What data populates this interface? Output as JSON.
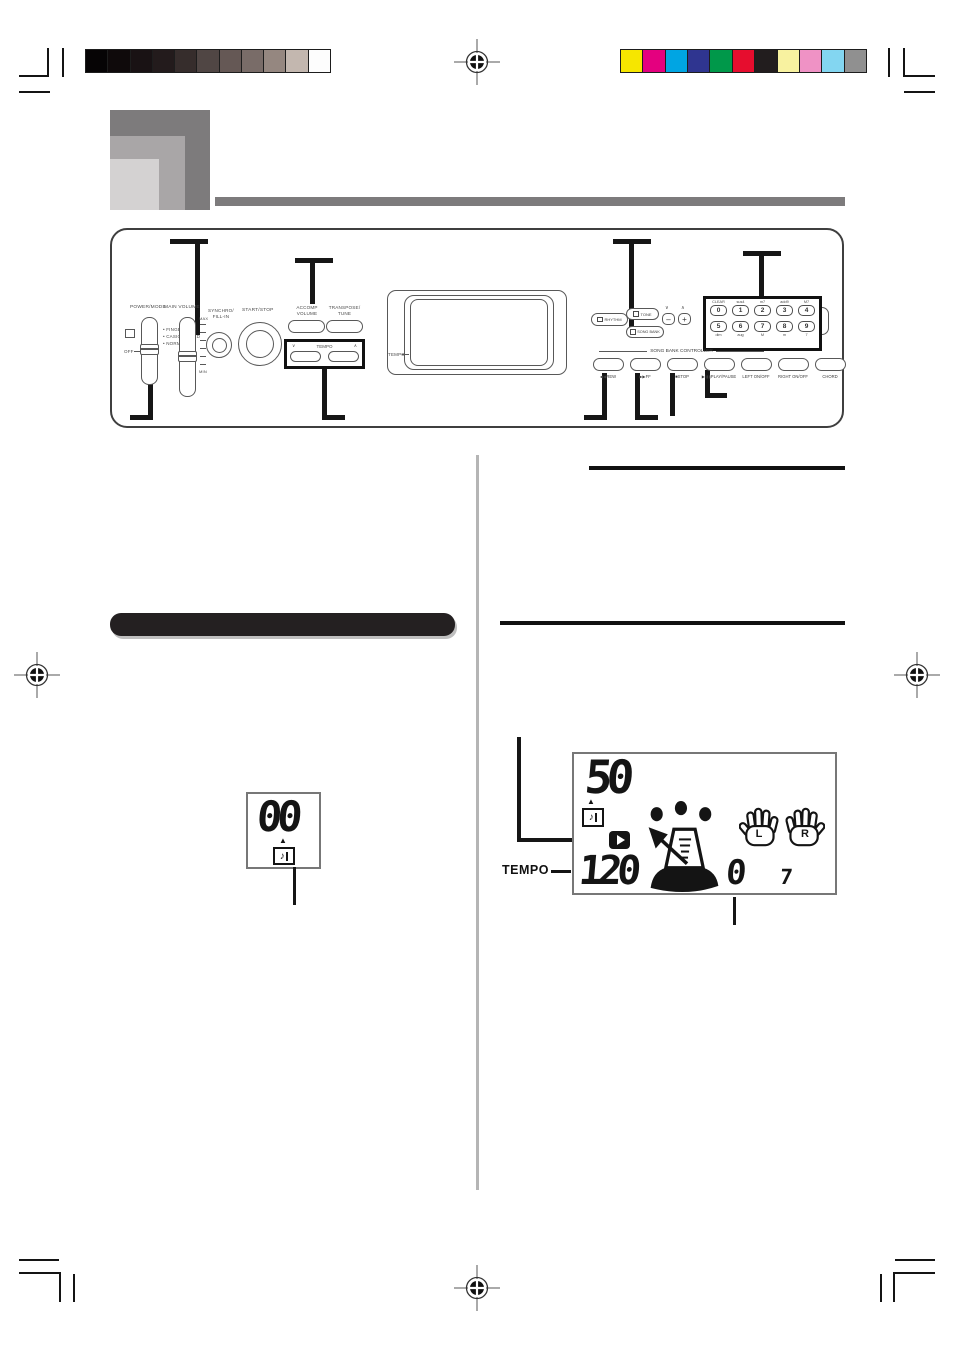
{
  "calibration": {
    "grayscale": [
      "#060405",
      "#0f0a0b",
      "#191214",
      "#231b1c",
      "#362d2c",
      "#504644",
      "#655855",
      "#796c68",
      "#958780",
      "#c3b7af",
      "#fdfdfd"
    ],
    "color_bar": [
      "#f6e600",
      "#e4007f",
      "#00a5e3",
      "#2f3590",
      "#00984a",
      "#e60d2e",
      "#221d1e",
      "#f8f2a0",
      "#ef92c5",
      "#83d6f1",
      "#909090"
    ]
  },
  "panel": {
    "power_mode_label": "POWER/MODE",
    "mode_options": [
      "• FINGERED",
      "• CASIO CHORD",
      "• NORMAL"
    ],
    "off_label": "OFF",
    "main_volume_label": "MAIN VOLUME",
    "max_label": "MAX",
    "min_label": "MIN",
    "synchro_line1": "SYNCHRO/",
    "synchro_line2": "FILL-IN",
    "start_stop_label": "START/STOP",
    "accomp_line1": "ACCOMP",
    "accomp_line2": "VOLUME",
    "transpose_line1": "TRANSPOSE/",
    "transpose_line2": "TUNE",
    "tempo_label": "TEMPO",
    "tempo_down_glyph": "∨",
    "tempo_up_glyph": "∧",
    "display_tempo_label": "TEMPO",
    "rhythm_label": "RHYTHM",
    "tone_label": "TONE",
    "song_bank_label": "SONG BANK",
    "value_down_glyph": "∨",
    "value_up_glyph": "∧",
    "minus_label": "–",
    "plus_label": "+",
    "keypad_digits_top": [
      "0",
      "1",
      "2",
      "3",
      "4"
    ],
    "keypad_digits_bottom": [
      "5",
      "6",
      "7",
      "8",
      "9"
    ],
    "keypad_labels_top": [
      "CLEAR",
      "sus4",
      "m7",
      "add9",
      "M7"
    ],
    "keypad_labels_bottom": [
      "dim",
      "aug",
      "M",
      "m",
      "7"
    ],
    "controller_title": "SONG BANK CONTROLLER",
    "transport_icons": [
      "◀◀",
      "▶▶",
      "■",
      "▶/▮▮",
      "",
      "",
      ""
    ],
    "transport_labels": [
      "REW",
      "FF",
      "STOP",
      "PLAY/PAUSE",
      "LEFT ON/OFF",
      "RIGHT ON/OFF",
      "CHORD"
    ]
  },
  "figures": {
    "small_display": {
      "number": "00"
    },
    "main_display": {
      "song_number": "50",
      "tempo_label": "TEMPO",
      "tempo_value": "120",
      "measure": "0",
      "beat": "7",
      "left_hand_letter": "L",
      "right_hand_letter": "R"
    }
  }
}
